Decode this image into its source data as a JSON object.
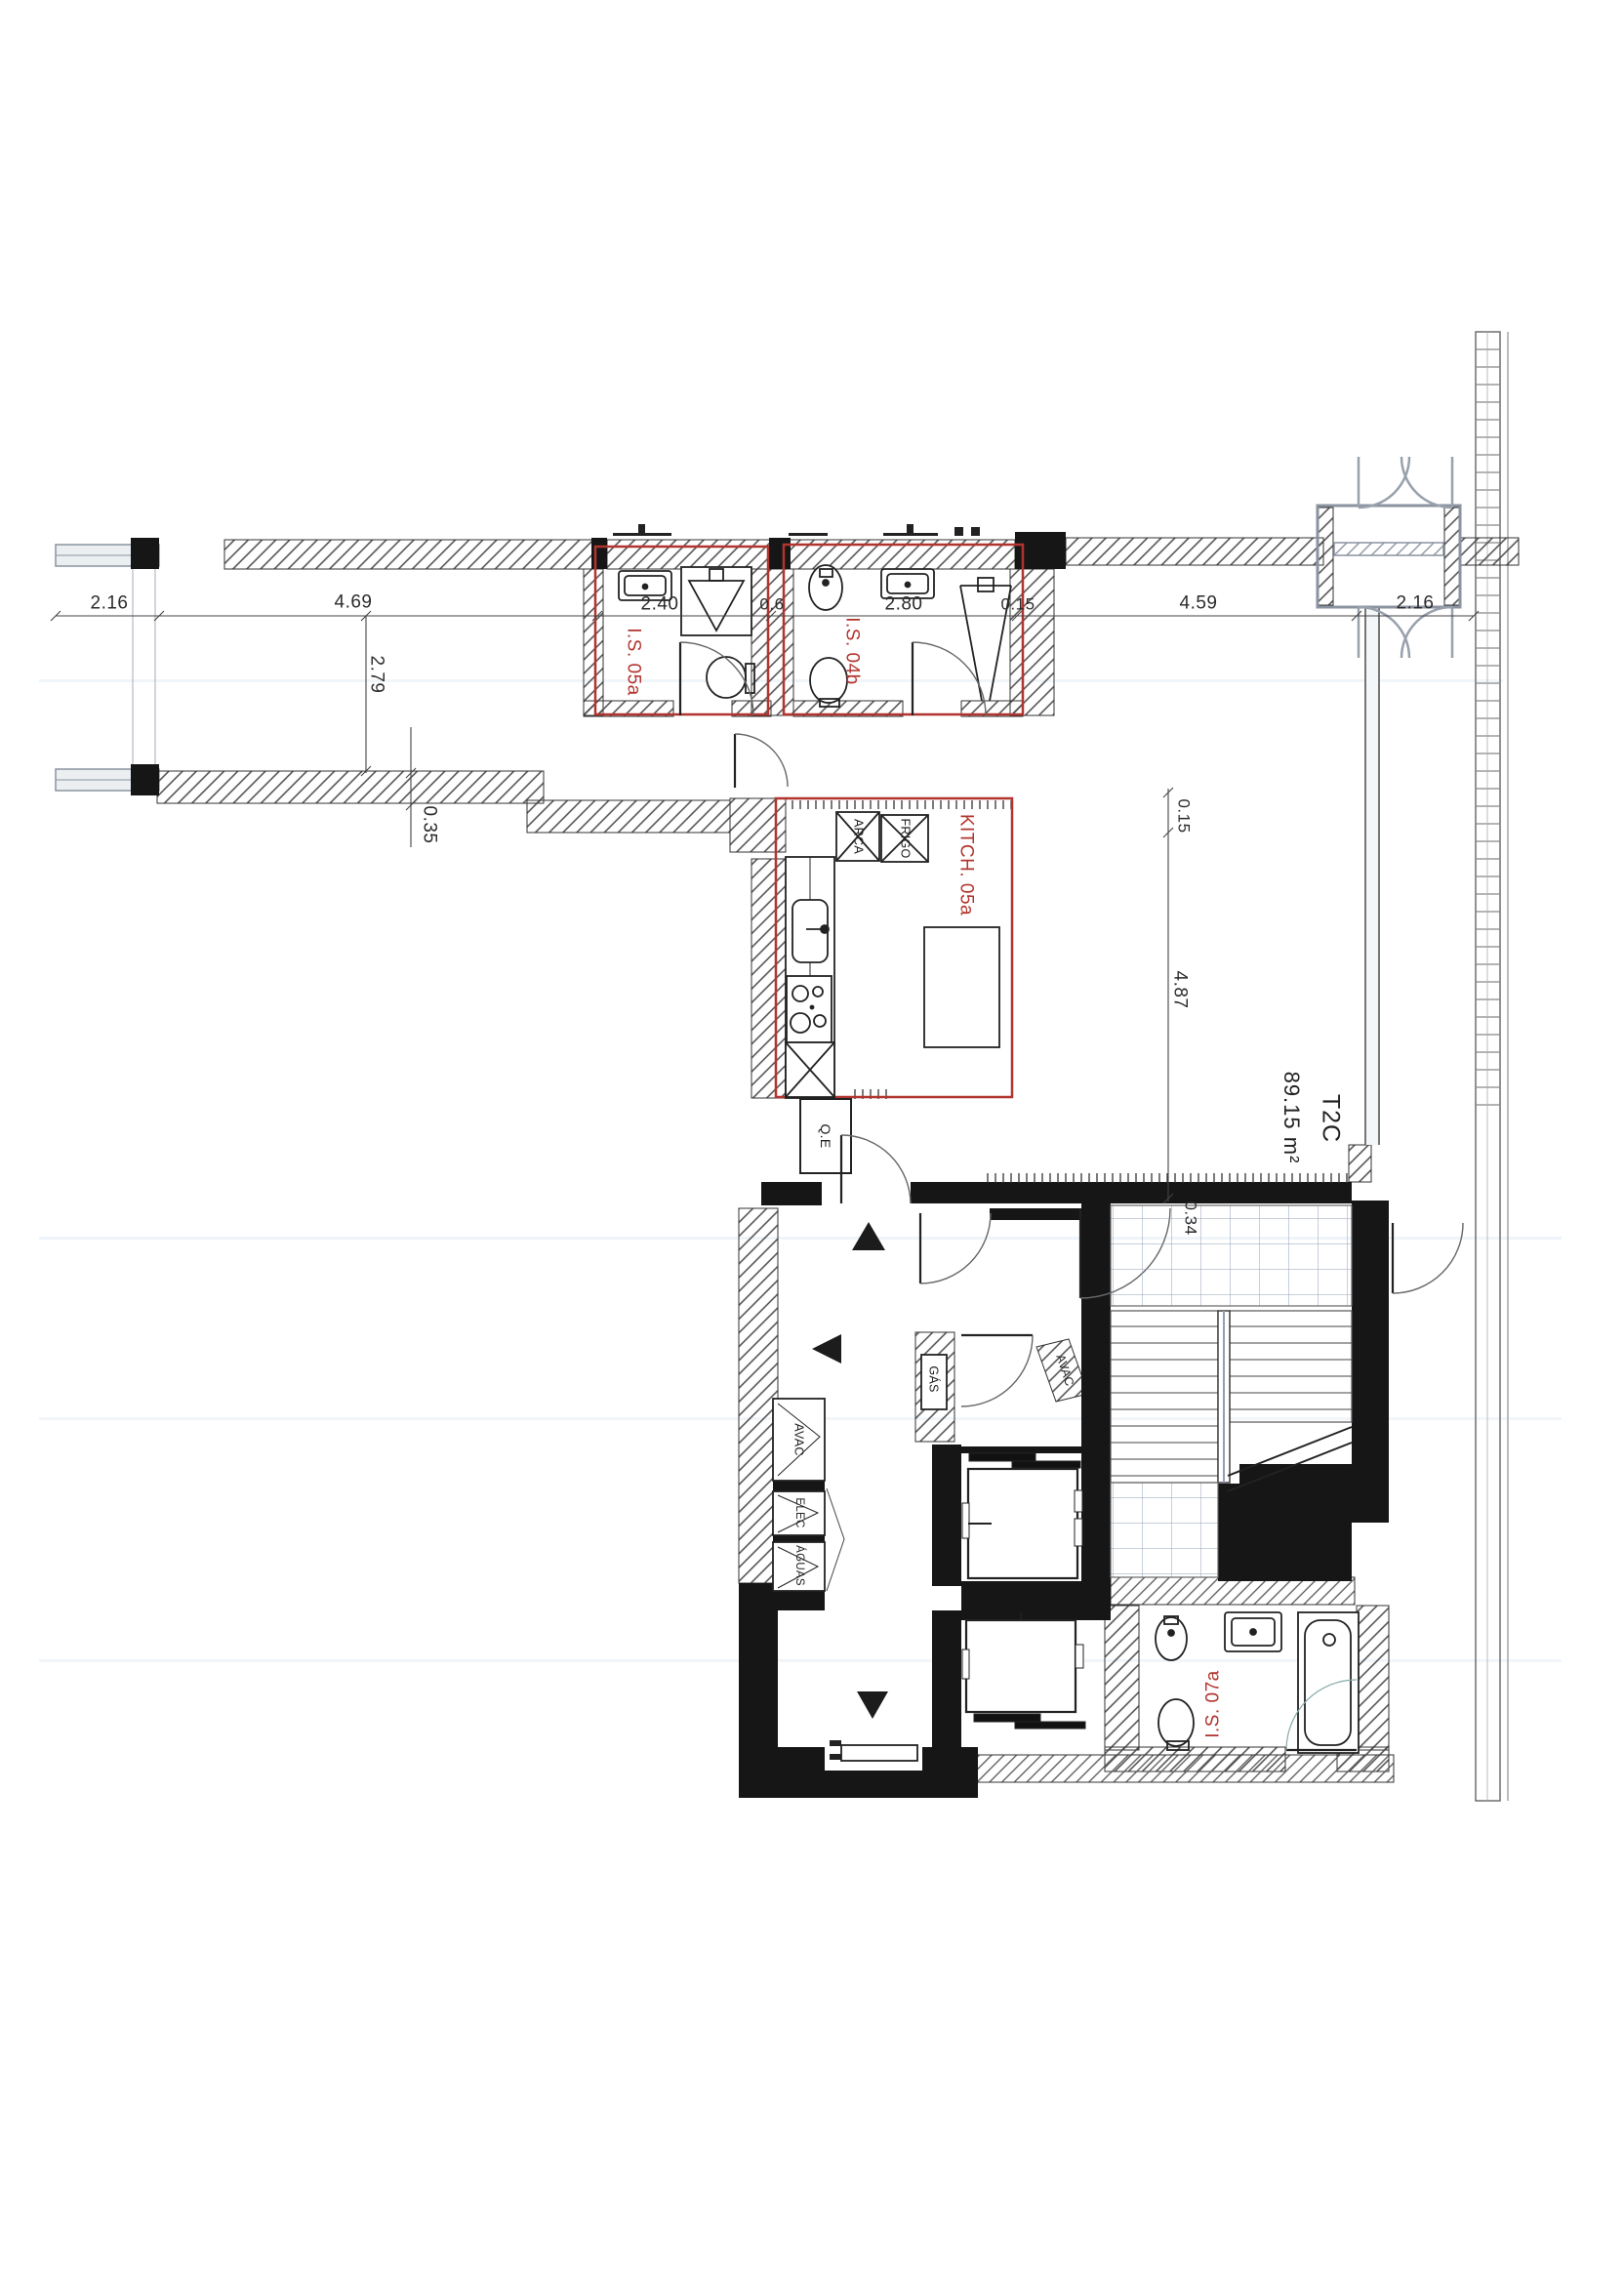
{
  "document": {
    "kind": "architectural-floor-plan",
    "style": "scanned blueprint, black linework on white with red unit annotations"
  },
  "colors": {
    "annotation_red": "#b2342e",
    "wall_black": "#161616",
    "hatch_gray": "#4a4a4a",
    "tile_blue": "#92a2b4",
    "window_gray": "#8a93a0",
    "paper": "#ffffff"
  },
  "apartment": {
    "code": "T2C",
    "area": "89.15 m²"
  },
  "rooms": {
    "is05a": {
      "label": "I.S. 05a"
    },
    "is04b": {
      "label": "I.S. 04b"
    },
    "kitchen": {
      "label": "KITCH. 05a"
    },
    "is07a": {
      "label": "I.S. 07a"
    }
  },
  "appliances": {
    "arca": "ARCA",
    "frigo": "FRIGO"
  },
  "panels": {
    "qe": "Q.E",
    "avac_left": "AVAC",
    "elec": "ELEC",
    "aguas": "ÁGUAS",
    "gas": "GÁS",
    "avac_shaft": "AVAC"
  },
  "dimensions": {
    "d216_left": "2.16",
    "d469": "4.69",
    "d240": "2.40",
    "d06": "0.6",
    "d280": "2.80",
    "d015_top": "0.15",
    "d459": "4.59",
    "d216_right": "2.16",
    "d279": "2.79",
    "d035": "0.35",
    "d015_side": "0.15",
    "d487": "4.87",
    "d034": "0.34"
  }
}
